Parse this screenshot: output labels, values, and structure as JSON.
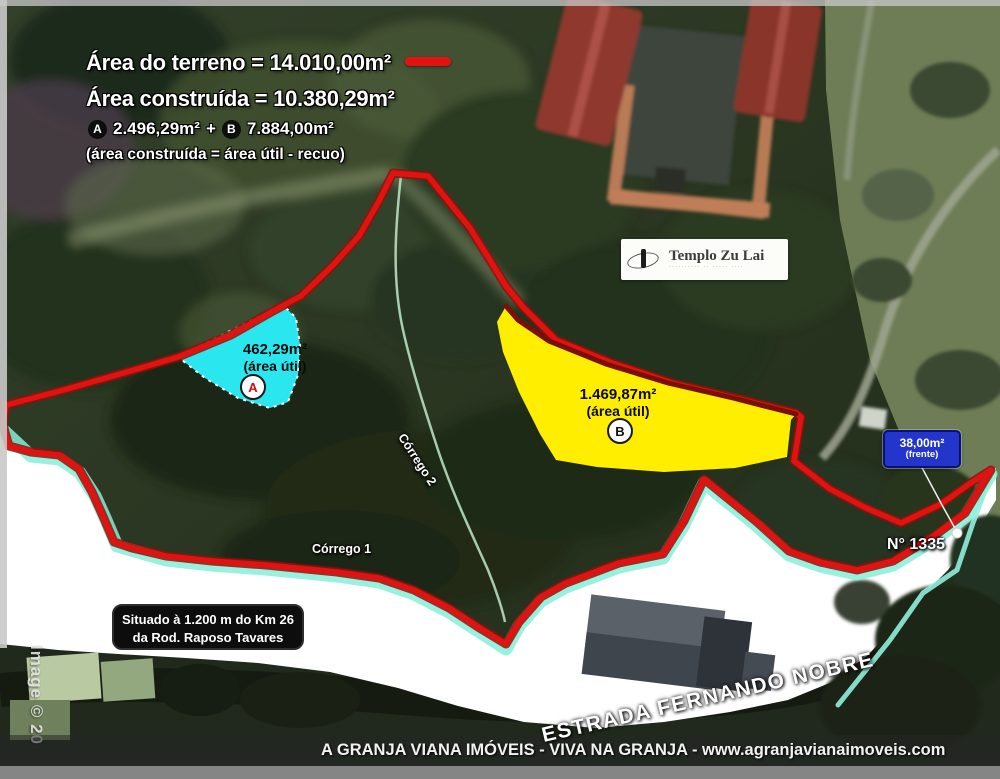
{
  "header": {
    "area_terreno": "Área do terreno = 14.010,00m²",
    "area_construida": "Área construída = 10.380,29m²",
    "badge_a": "A",
    "area_a": "2.496,29m²",
    "plus": "+",
    "badge_b": "B",
    "area_b": "7.884,00m²",
    "note": "(área construída = área útil - recuo)"
  },
  "map": {
    "temple": {
      "title": "Templo Zu Lai",
      "subtitle": "·········· ·· ····· ····"
    },
    "region_a": {
      "area": "462,29m²",
      "label": "(área útil)",
      "badge": "A"
    },
    "region_b": {
      "area": "1.469,87m²",
      "label": "(área útil)",
      "badge": "B"
    },
    "frente": {
      "area": "38,00m²",
      "label": "(frente)"
    },
    "street_number": "N° 1335",
    "corrego_1": "Córrego 1",
    "corrego_2": "Córrego 2",
    "situado_line1": "Situado à 1.200 m do Km 26",
    "situado_line2": "da Rod. Raposo Tavares",
    "road_name": "ESTRADA FERNANDO NOBRE",
    "watermark": "Image © 20"
  },
  "footer": {
    "text": "A GRANJA VIANA IMÓVEIS - VIVA NA GRANJA  -  www.agranjavianaimoveis.com"
  },
  "colors": {
    "boundary_red": "#e01313",
    "boundary_dark_red": "#8f1206",
    "region_a_cyan": "#29e6ef",
    "region_b_yellow": "#ffee00",
    "frente_blue": "#2435cb",
    "stream_cyan": "#86efd9",
    "highlight_dash_red": "#e31313"
  }
}
